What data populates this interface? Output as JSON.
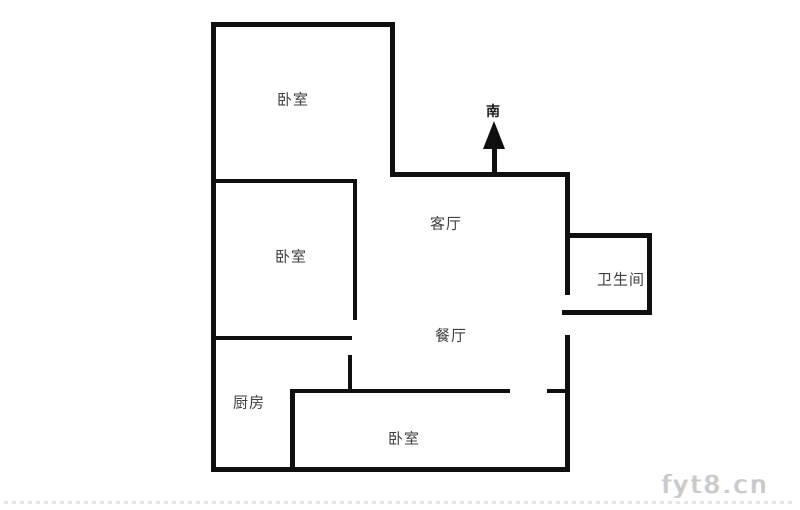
{
  "floor_plan": {
    "compass": {
      "label": "南"
    },
    "rooms": [
      {
        "id": "bedroom-top",
        "label": "卧室"
      },
      {
        "id": "bedroom-middle",
        "label": "卧室"
      },
      {
        "id": "living-room",
        "label": "客厅"
      },
      {
        "id": "bathroom",
        "label": "卫生间"
      },
      {
        "id": "dining-room",
        "label": "餐厅"
      },
      {
        "id": "kitchen",
        "label": "厨房"
      },
      {
        "id": "bedroom-bottom",
        "label": "卧室"
      }
    ]
  },
  "watermark": {
    "text": "fyt8.cn"
  },
  "colors": {
    "wall": "#0f0f0f",
    "label": "#3f3f3f",
    "watermark": "#c7c9cb",
    "background": "#ffffff"
  }
}
